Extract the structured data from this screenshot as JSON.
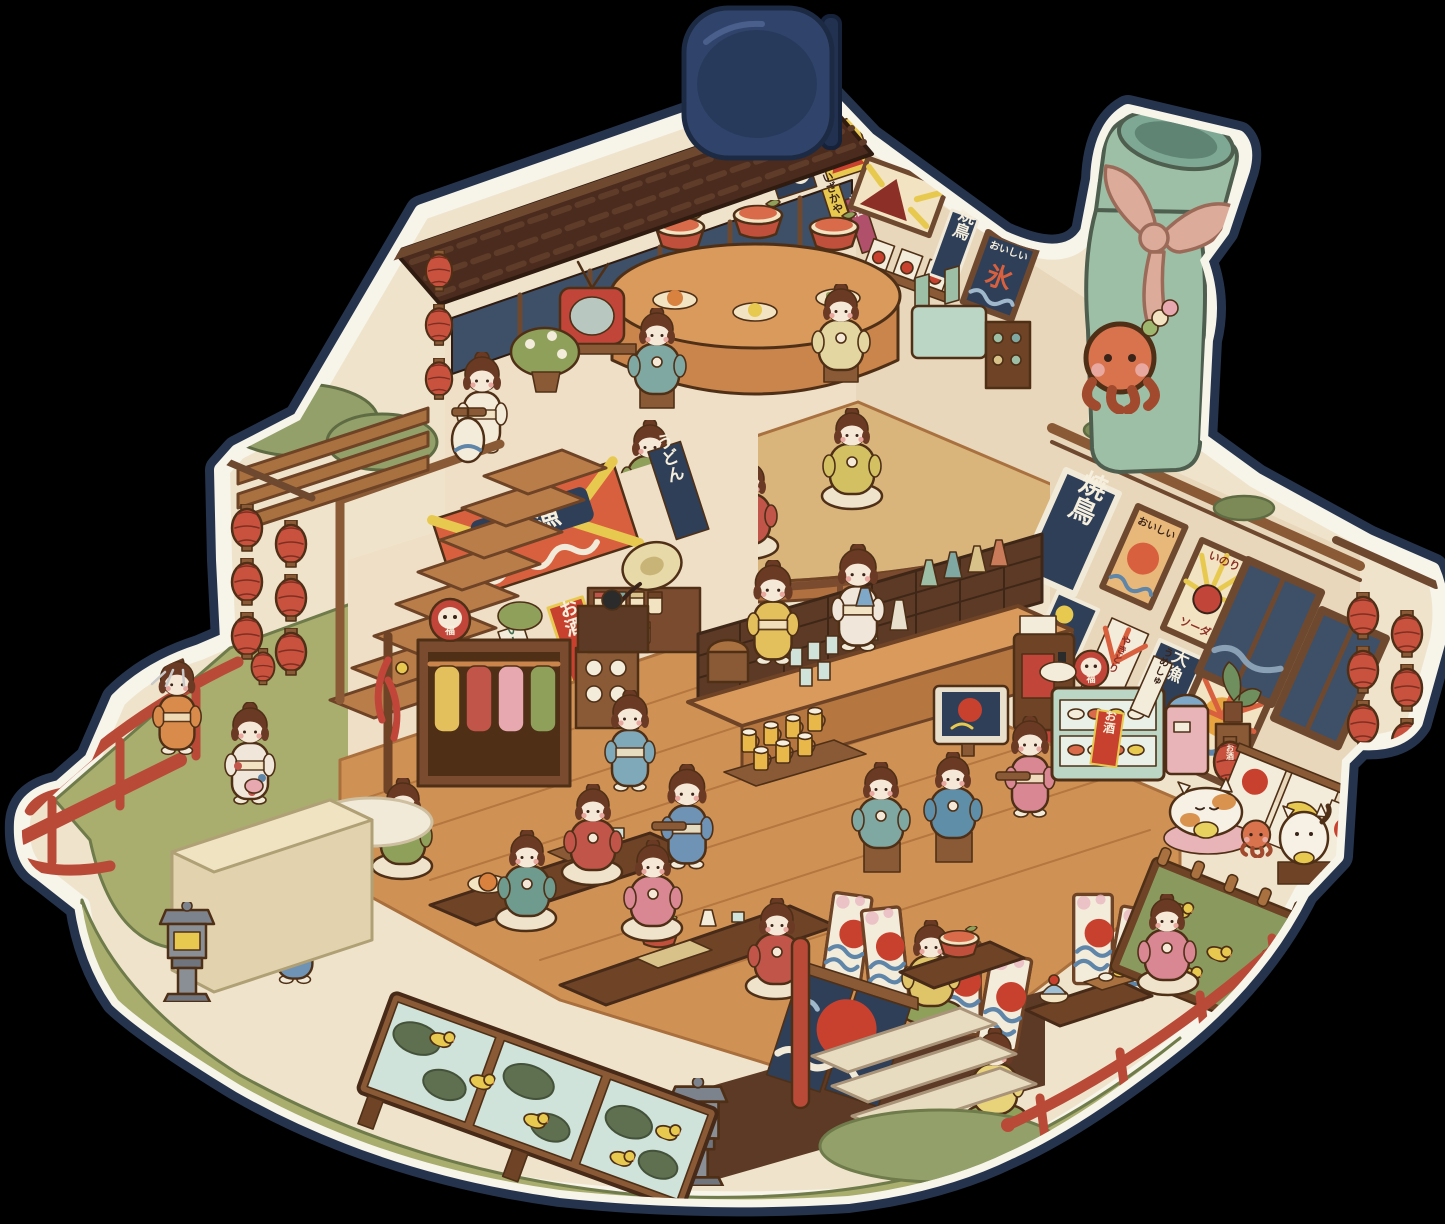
{
  "scene": {
    "description": "Die-cut sticker illustration of a two-storey Japanese izakaya restaurant in cute isometric cutaway style, pinned by a navy binder clip on a black background",
    "style": "chibi watercolor diorama",
    "floors": 2,
    "character_count": 25
  },
  "signs": {
    "yakitori": "焼鳥",
    "tairyo": "大漁",
    "osake": "お酒",
    "seishu": "せいしゅ",
    "izakaya": "いざかや",
    "oishii": "おいしい",
    "inori": "いのり",
    "soda": "ソーダ",
    "udon": "うどん",
    "umeshu": "うめしゅ",
    "yakitori_kana": "やきとり",
    "koori": "氷",
    "fuku": "福"
  },
  "details": {
    "red_lanterns_right_cluster": 6,
    "red_lanterns_left_cluster": 6,
    "roof_corner_lanterns": 3,
    "beer_mugs_on_tray": 7,
    "duck_pond_sections": 3,
    "folding_screens": 3,
    "octopus_mascots": 3,
    "lucky_cat": 1,
    "sleeping_cat": 1
  },
  "palette": {
    "background": "#000000",
    "sticker_border": "#f7f4ea",
    "sticker_shadow": "#273750",
    "clip_navy": "#30446b",
    "wall_cream": "#eedfc6",
    "roof_brown": "#4a2b1d",
    "wood": "#c9854b",
    "deck": "#cf9254",
    "grass": "#a9ad6e",
    "lantern_red": "#c8523e",
    "accent_red": "#b94a38",
    "window_navy": "#3d5068",
    "bottle_green": "#9dbfa6"
  }
}
